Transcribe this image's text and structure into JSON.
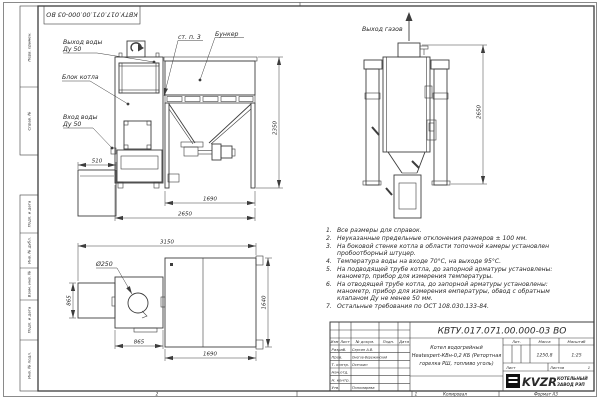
{
  "colors": {
    "ink": "#3d3d3d",
    "text": "#2a2a2a",
    "paper": "#ffffff"
  },
  "stamp_top": {
    "number": "КВТУ.017.071.00.000-03 ВО"
  },
  "frame": {
    "left_fields": [
      "Перв. примен.",
      "Справ. №",
      "Подп. и дата",
      "Инв. № дубл.",
      "Взам. инв. №",
      "Подп. и дата",
      "Инв. № подл."
    ],
    "fold_left": "2",
    "fold_right": "1",
    "copied": "Копировал",
    "format": "Формат А3"
  },
  "front": {
    "label_water_out_1": "Выход воды",
    "label_water_out_2": "Ду 50",
    "label_block": "Блок котла",
    "label_water_in_1": "Вход воды",
    "label_water_in_2": "Ду 50",
    "label_wall": "ст. п. 3",
    "label_bunker": "Бункер",
    "dim_width_small": "510",
    "dim_bunker_width": "1690",
    "dim_total_width": "2650",
    "dim_height": "2350"
  },
  "side": {
    "label_gas_out": "Выход газов",
    "dim_height": "2650"
  },
  "plan": {
    "dim_total_width": "3150",
    "label_dia": "Ø250",
    "dim_left_depth": "865",
    "dim_boiler_width": "865",
    "dim_depth": "1640",
    "dim_bunker_width": "1690"
  },
  "notes": {
    "items": [
      {
        "num": "1.",
        "text": "Все размеры для справок."
      },
      {
        "num": "2.",
        "text": "Неуказанные предельные отклонения размеров ± 100 мм."
      },
      {
        "num": "3.",
        "text": "На боковой стенке котла в области топочной камеры установлен пробоотборный штуцер."
      },
      {
        "num": "4.",
        "text": "Температура воды на входе 70°С, на выходе 95°С."
      },
      {
        "num": "5.",
        "text": "На подводящей трубе котла, до запорной арматуры установлены: манометр, прибор для измерения температуры."
      },
      {
        "num": "6.",
        "text": "На отводящей трубе котла, до запорной арматуры установлены: манометр, прибор для измерения емпературы, обвод с обратным клапаном Ду не менее 50 мм."
      },
      {
        "num": "7.",
        "text": "Остальные требования по ОСТ 108.030.133-84."
      }
    ]
  },
  "title_block": {
    "doc_number": "КВТУ.017.071.00.000-03 ВО",
    "name_line1": "Котел водогрейный",
    "name_line2": "Heatexpert-КВн-0,2 КБ (Ретортная",
    "name_line3": "горелка РШ, топливо уголь)",
    "col_izm": "Изм",
    "col_list": "Лист",
    "col_doc": "№ докум.",
    "col_podp": "Подп.",
    "col_data": "Дата",
    "row_razrab": "Разраб.",
    "row_prov": "Пров.",
    "row_tkontr": "Т. контр.",
    "row_nachotd": "Нач.отд.",
    "row_nkontr": "Н. контр.",
    "row_utv": "Утв.",
    "name_razrab": "Сергин А.В.",
    "name_prov": "Онегов-Вережинский",
    "name_tkontr": "Осечкин",
    "name_utv": "Пономарева",
    "lit_label": "Лит.",
    "mass_label": "Масса",
    "scale_label": "Масштаб",
    "mass_value": "1250,8",
    "scale_value": "1:25",
    "sheet_label": "Лист",
    "sheets_label": "Листов",
    "sheets_value": "1",
    "logo_text": "KVZR",
    "logo_line1": "КОТЕЛЬНЫЙ",
    "logo_line2": "ЗАВОД РЭП"
  }
}
